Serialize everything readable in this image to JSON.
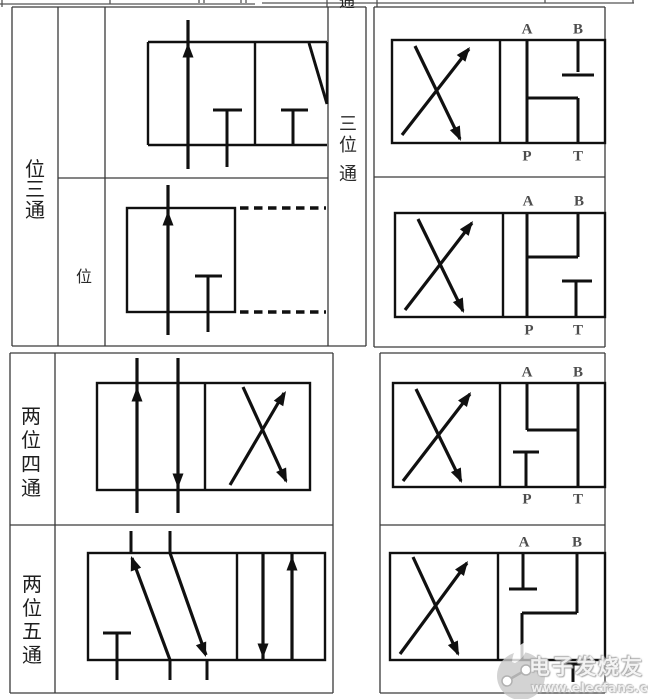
{
  "colors": {
    "background": "#ffffff",
    "grid_line": "#3a3a3a",
    "symbol_line": "#101010",
    "port_label": "#4d4d4d",
    "watermark_gray": "#c9c9c9"
  },
  "top_strip": {
    "partial_char": "通"
  },
  "upper": {
    "col1_label_chars": [
      "位",
      "三",
      "通"
    ],
    "col2_label": "位",
    "middle_column_chars": [
      "三",
      "位",
      "通"
    ]
  },
  "lower": {
    "row3_label_chars": [
      "两",
      "位",
      "四",
      "通"
    ],
    "row4_label_chars": [
      "两",
      "位",
      "五",
      "通"
    ]
  },
  "ports": {
    "a": "A",
    "b": "B",
    "p": "P",
    "t": "T"
  },
  "watermark": {
    "name": "电子发烧友",
    "url": "www.elecfans.com"
  }
}
